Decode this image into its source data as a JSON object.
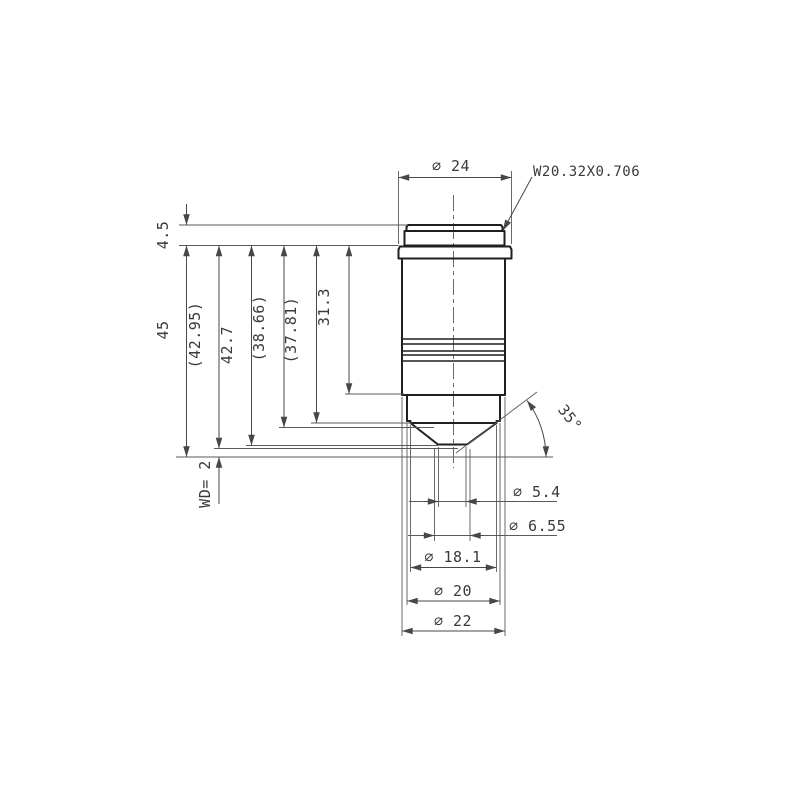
{
  "drawing": {
    "kind": "technical-drawing",
    "colors": {
      "background": "#ffffff",
      "outline": "#1f1f1f",
      "dimension": "#3a3a3a"
    },
    "labels": {
      "top_diameter": "∅ 24",
      "thread_spec": "W20.32X0.706",
      "height_4_5": "4.5",
      "height_45": "45",
      "height_42_95": "(42.95)",
      "height_42_7": "42.7",
      "height_38_66": "(38.66)",
      "height_37_81": "(37.81)",
      "height_31_3": "31.3",
      "working_distance": "WD= 2",
      "cone_angle": "35°",
      "dia_5_4": "∅ 5.4",
      "dia_6_55": "∅ 6.55",
      "dia_18_1": "∅ 18.1",
      "dia_20": "∅ 20",
      "dia_22": "∅ 22"
    }
  }
}
